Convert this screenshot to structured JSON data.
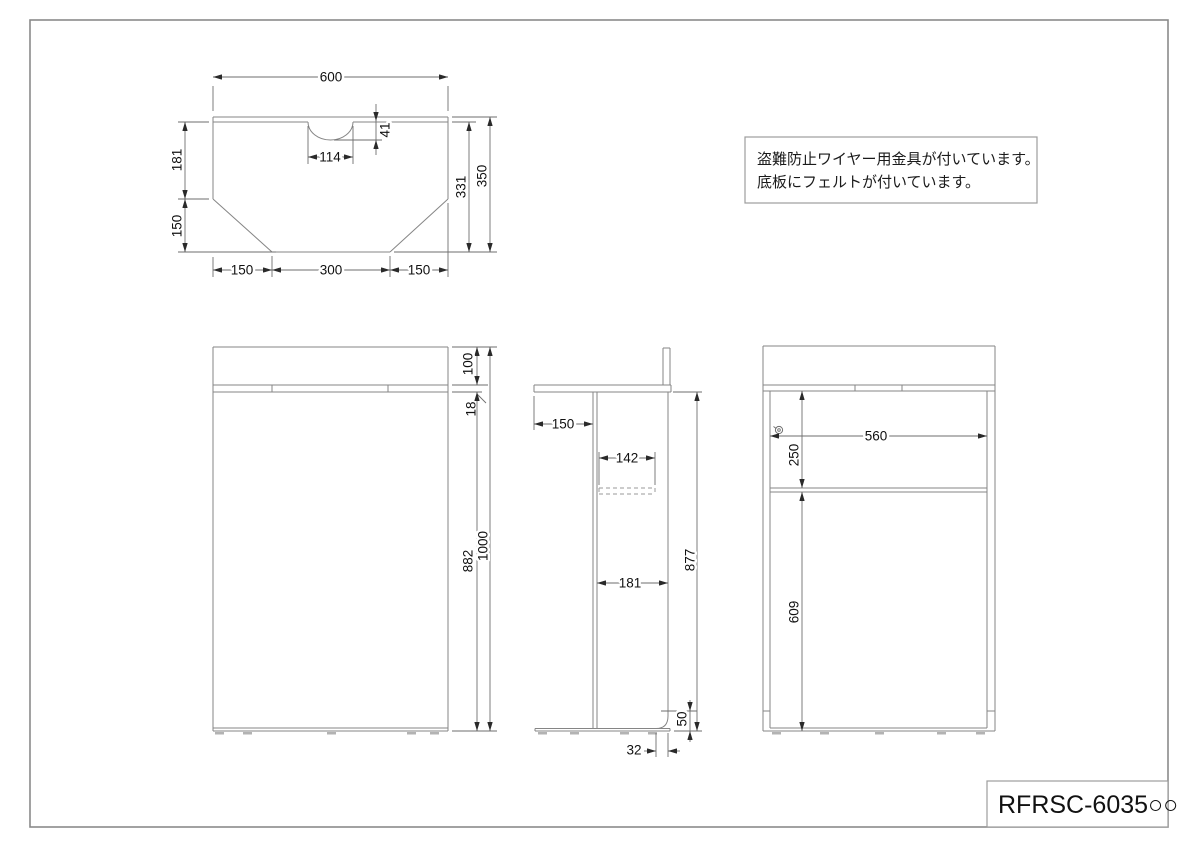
{
  "title_block": {
    "part_number": "RFRSC-6035○○"
  },
  "note_box": {
    "line1": "盗難防止ワイヤー用金具が付いています。",
    "line2": "底板にフェルトが付いています。"
  },
  "dimensions": {
    "top_view": {
      "width": "600",
      "notch_width": "114",
      "notch_depth": "41",
      "left_upper": "181",
      "left_lower": "150",
      "depth_inner": "331",
      "depth_total": "350",
      "bottom_left": "150",
      "bottom_center": "300",
      "bottom_right": "150"
    },
    "front_view": {
      "back_panel_height": "100",
      "top_thickness": "18",
      "body_height": "882",
      "total_height": "1000"
    },
    "side_view": {
      "overhang": "150",
      "shelf_depth": "142",
      "body_depth": "181",
      "body_height": "877",
      "cutout_height": "50",
      "cutout_depth": "32"
    },
    "back_view": {
      "inner_width": "560",
      "upper_opening_height": "250",
      "lower_height": "609"
    }
  }
}
